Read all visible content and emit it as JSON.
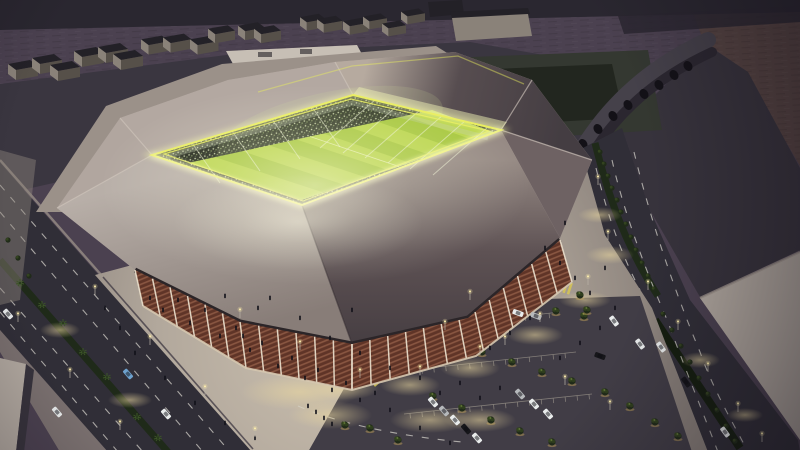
{
  "meta": {
    "title": "Aerial night rendering of an illuminated stadium with glowing pitch, wooden facade, plazas, parking lots and boulevards",
    "type": "architectural-visualization"
  },
  "colors": {
    "desert": "#4b4150",
    "desertRed": "#564442",
    "roadTop": "#2a2730",
    "apron": "#3a3640",
    "dark2": "#37333c",
    "lot": "#b2a9a0",
    "field": "#343831",
    "fieldIn": "#22261f",
    "greenRoof": "#c7bfb5",
    "greenA": "#2d6a33",
    "greenB": "#7fbd5b",
    "viaduct": "#45414a",
    "viaductSide": "#2b2730",
    "arch": "#131117",
    "road": "#302e37",
    "lane": "#d2cfc8",
    "walk": "#9c938a",
    "median": "#1f2a19",
    "hedge": "#151e0f",
    "plazaIn": "#cdc2b1",
    "plazaMid": "#b2a89c",
    "plazaOut": "#89807a",
    "plazaDim": "#8e857c",
    "pool": "#ecd9a0",
    "parking": "#413d46",
    "aisle": "#938d85",
    "apronX": "#9b9189",
    "roofA": "#b1a69f",
    "roofTL": "#b3a8a1",
    "roofTRa": "#b6aa9f",
    "roofTRb": "#574d50",
    "roofTRc": "#443d42",
    "roofR": "#6e6263",
    "roofDa": "#968a84",
    "roofDb": "#5e5254",
    "roofDc": "#463e42",
    "roofLa": "#b8afa8",
    "roofLb": "#887d78",
    "ridge": "#cfc5bb",
    "crease": "#2f282c",
    "under": "#2b2528",
    "wood": "#5f3427",
    "slat": "#8a5742",
    "column": "#eadfcc",
    "base": "#d6c8b0",
    "canopy": "#d9d3c8",
    "rim": "#e9ee5e",
    "rimSoft": "#f7f8ac",
    "rimHot": "#fffce2",
    "trussBand": "#e9ecb2",
    "truss": "#eef2d4",
    "stands": "#1a2014",
    "crowd1": "#dce6b8",
    "crowd2": "#8fa468",
    "crowd3": "#4c5a3c",
    "crowdGlow": "#cfe09a",
    "pitch": "#a6c73d",
    "pitchHi": "#cbe35a",
    "pitchLine": "#eef3c0",
    "boxTop": "#232127",
    "boxFaceL": "#8a8279",
    "boxFaceR": "#565049",
    "treeDark": "#202b19",
    "treeMid": "#33431f",
    "treeHi": "#5d7334",
    "treeGlow": "#caa85c",
    "palm": "#3c5528",
    "person": "#101018",
    "pole": "#b9b2a6",
    "poleLight": "#ffefad",
    "carWhite": "#e9ecec",
    "carSilver": "#b6b9bc",
    "carBlue": "#6ea2ce",
    "carDark": "#16161a",
    "bloom": "#fffbe6",
    "vig": "#120e17",
    "crossYellow": "#d6c654"
  },
  "scene": {
    "warehouses": [
      [
        8,
        72,
        1
      ],
      [
        32,
        66,
        1
      ],
      [
        50,
        73,
        1
      ],
      [
        74,
        59,
        1
      ],
      [
        98,
        55,
        1
      ],
      [
        113,
        62,
        1
      ],
      [
        141,
        47,
        0.95
      ],
      [
        163,
        45,
        0.95
      ],
      [
        190,
        47,
        0.95
      ],
      [
        208,
        36,
        0.9
      ],
      [
        238,
        33,
        0.9
      ],
      [
        254,
        36,
        0.9
      ],
      [
        300,
        24,
        0.85
      ],
      [
        317,
        26,
        0.85
      ],
      [
        343,
        28,
        0.85
      ],
      [
        363,
        23,
        0.8
      ],
      [
        382,
        30,
        0.8
      ],
      [
        401,
        18,
        0.8
      ]
    ],
    "arches": [
      [
        688,
        66
      ],
      [
        674,
        75
      ],
      [
        659,
        85
      ],
      [
        644,
        94
      ],
      [
        628,
        105
      ],
      [
        613,
        116
      ],
      [
        598,
        129
      ],
      [
        583,
        144
      ],
      [
        569,
        159
      ],
      [
        557,
        173
      ]
    ],
    "medianTrees": [
      [
        600,
        152
      ],
      [
        604,
        164
      ],
      [
        608,
        176
      ],
      [
        612,
        188
      ],
      [
        617,
        200
      ],
      [
        621,
        212
      ],
      [
        626,
        224
      ],
      [
        631,
        237
      ],
      [
        636,
        250
      ],
      [
        642,
        263
      ],
      [
        648,
        276
      ],
      [
        654,
        289
      ]
    ],
    "hedgeTrees": [
      [
        663,
        314
      ],
      [
        672,
        330
      ],
      [
        681,
        346
      ],
      [
        690,
        362
      ],
      [
        699,
        378
      ],
      [
        708,
        394
      ],
      [
        717,
        410
      ],
      [
        726,
        426
      ],
      [
        735,
        441
      ]
    ],
    "plazaTrees": [
      [
        498,
        262
      ],
      [
        523,
        265
      ],
      [
        552,
        232
      ],
      [
        550,
        268
      ],
      [
        562,
        272
      ],
      [
        580,
        295
      ],
      [
        587,
        310
      ],
      [
        540,
        300
      ],
      [
        520,
        285
      ],
      [
        505,
        300
      ],
      [
        559,
        253
      ],
      [
        512,
        272
      ]
    ],
    "leftTrees": [
      [
        8,
        240
      ],
      [
        18,
        258
      ],
      [
        29,
        276
      ]
    ],
    "palms": [
      [
        20,
        283
      ],
      [
        42,
        305
      ],
      [
        63,
        323
      ],
      [
        83,
        352
      ],
      [
        107,
        377
      ],
      [
        137,
        417
      ],
      [
        158,
        438
      ]
    ],
    "parkTrees": [
      [
        442,
        296
      ],
      [
        468,
        300
      ],
      [
        497,
        303
      ],
      [
        526,
        307
      ],
      [
        556,
        311
      ],
      [
        584,
        316
      ],
      [
        424,
        332
      ],
      [
        452,
        342
      ],
      [
        482,
        352
      ],
      [
        512,
        362
      ],
      [
        542,
        372
      ],
      [
        572,
        381
      ],
      [
        433,
        396
      ],
      [
        462,
        408
      ],
      [
        491,
        420
      ],
      [
        520,
        431
      ],
      [
        552,
        442
      ],
      [
        605,
        392
      ],
      [
        630,
        406
      ],
      [
        655,
        422
      ],
      [
        678,
        436
      ],
      [
        398,
        440
      ],
      [
        370,
        428
      ],
      [
        345,
        425
      ]
    ],
    "people": [
      [
        150,
        300
      ],
      [
        163,
        312
      ],
      [
        178,
        302
      ],
      [
        190,
        325
      ],
      [
        205,
        312
      ],
      [
        220,
        338
      ],
      [
        236,
        330
      ],
      [
        250,
        352
      ],
      [
        262,
        345
      ],
      [
        278,
        368
      ],
      [
        292,
        360
      ],
      [
        305,
        380
      ],
      [
        318,
        372
      ],
      [
        332,
        392
      ],
      [
        346,
        385
      ],
      [
        360,
        402
      ],
      [
        375,
        395
      ],
      [
        390,
        412
      ],
      [
        270,
        300
      ],
      [
        300,
        320
      ],
      [
        330,
        340
      ],
      [
        360,
        355
      ],
      [
        390,
        370
      ],
      [
        420,
        380
      ],
      [
        440,
        395
      ],
      [
        460,
        385
      ],
      [
        480,
        400
      ],
      [
        500,
        390
      ],
      [
        560,
        360
      ],
      [
        580,
        345
      ],
      [
        600,
        330
      ],
      [
        615,
        310
      ],
      [
        545,
        250
      ],
      [
        560,
        265
      ],
      [
        575,
        280
      ],
      [
        590,
        295
      ],
      [
        605,
        270
      ],
      [
        565,
        225
      ],
      [
        120,
        330
      ],
      [
        105,
        310
      ],
      [
        135,
        355
      ],
      [
        165,
        380
      ],
      [
        195,
        405
      ],
      [
        225,
        425
      ],
      [
        255,
        440
      ],
      [
        308,
        408
      ],
      [
        316,
        414
      ],
      [
        324,
        420
      ],
      [
        332,
        426
      ],
      [
        420,
        430
      ],
      [
        450,
        445
      ],
      [
        352,
        312
      ],
      [
        225,
        298
      ],
      [
        530,
        320
      ],
      [
        510,
        335
      ],
      [
        490,
        350
      ],
      [
        258,
        310
      ],
      [
        243,
        338
      ]
    ],
    "pools": [
      [
        165,
        295,
        28,
        10
      ],
      [
        225,
        330,
        30,
        11
      ],
      [
        285,
        362,
        32,
        12
      ],
      [
        345,
        388,
        34,
        12
      ],
      [
        410,
        385,
        30,
        11
      ],
      [
        470,
        368,
        30,
        11
      ],
      [
        535,
        335,
        28,
        10
      ],
      [
        585,
        300,
        26,
        9
      ],
      [
        610,
        255,
        24,
        9
      ],
      [
        600,
        215,
        22,
        8
      ],
      [
        330,
        415,
        42,
        14
      ],
      [
        430,
        420,
        40,
        13
      ],
      [
        520,
        300,
        26,
        10
      ],
      [
        480,
        420,
        36,
        12
      ],
      [
        300,
        392,
        60,
        18
      ],
      [
        60,
        330,
        20,
        8
      ],
      [
        130,
        400,
        22,
        8
      ],
      [
        700,
        360,
        20,
        8
      ],
      [
        745,
        415,
        18,
        7
      ],
      [
        208,
        300,
        24,
        9
      ]
    ],
    "poles": [
      [
        95,
        295
      ],
      [
        150,
        345
      ],
      [
        205,
        395
      ],
      [
        255,
        437
      ],
      [
        18,
        322
      ],
      [
        70,
        378
      ],
      [
        120,
        430
      ],
      [
        240,
        318
      ],
      [
        300,
        350
      ],
      [
        360,
        378
      ],
      [
        420,
        375
      ],
      [
        480,
        355
      ],
      [
        540,
        322
      ],
      [
        588,
        285
      ],
      [
        608,
        240
      ],
      [
        648,
        290
      ],
      [
        678,
        330
      ],
      [
        708,
        372
      ],
      [
        738,
        412
      ],
      [
        762,
        442
      ],
      [
        445,
        330
      ],
      [
        505,
        345
      ],
      [
        470,
        300
      ],
      [
        565,
        385
      ],
      [
        610,
        410
      ],
      [
        598,
        185
      ]
    ],
    "cars": [
      [
        8,
        314,
        49,
        "carWhite"
      ],
      [
        128,
        374,
        49,
        "carBlue"
      ],
      [
        57,
        412,
        49,
        "carWhite"
      ],
      [
        166,
        414,
        49,
        "carWhite"
      ],
      [
        614,
        321,
        54,
        "carWhite"
      ],
      [
        640,
        344,
        54,
        "carWhite"
      ],
      [
        661,
        347,
        54,
        "carWhite"
      ],
      [
        686,
        382,
        54,
        "carDark"
      ],
      [
        725,
        432,
        54,
        "carWhite"
      ],
      [
        433,
        402,
        49,
        "carWhite"
      ],
      [
        444,
        411,
        49,
        "carSilver"
      ],
      [
        455,
        420,
        49,
        "carWhite"
      ],
      [
        466,
        429,
        49,
        "carDark"
      ],
      [
        477,
        438,
        49,
        "carWhite"
      ],
      [
        520,
        394,
        49,
        "carSilver"
      ],
      [
        534,
        404,
        49,
        "carWhite"
      ],
      [
        548,
        414,
        49,
        "carWhite"
      ],
      [
        518,
        313,
        20,
        "carWhite"
      ],
      [
        536,
        316,
        20,
        "carSilver"
      ],
      [
        600,
        356,
        20,
        "carDark"
      ]
    ],
    "trusses": [
      [
        375,
        100,
        320,
        148
      ],
      [
        398,
        105,
        343,
        153
      ],
      [
        420,
        110,
        365,
        158
      ],
      [
        443,
        115,
        388,
        163
      ],
      [
        465,
        121,
        410,
        169
      ],
      [
        488,
        127,
        433,
        175
      ],
      [
        192,
        143,
        220,
        183
      ],
      [
        232,
        131,
        260,
        171
      ],
      [
        272,
        119,
        300,
        159
      ],
      [
        312,
        107,
        340,
        147
      ]
    ],
    "crosswalks": [
      {
        "x": 372,
        "y": 374,
        "r": 50,
        "n": 6
      },
      {
        "x": 412,
        "y": 304,
        "r": 18,
        "n": 5
      },
      {
        "x": 562,
        "y": 286,
        "r": 18,
        "n": 5
      }
    ],
    "aisles": [
      [
        400,
        330,
        560,
        312
      ],
      [
        392,
        372,
        576,
        352
      ],
      [
        404,
        414,
        592,
        394
      ]
    ],
    "pitch": {
      "E": [
        [
          188,
          163
        ],
        [
          432,
          110
        ]
      ],
      "F": [
        [
          302,
          200
        ],
        [
          496,
          133
        ]
      ],
      "stripes": 9
    },
    "facadeLeft": {
      "top": [
        [
          135,
          270
        ],
        [
          240,
          322
        ],
        [
          352,
          344
        ]
      ],
      "bottom": [
        [
          143,
          306
        ],
        [
          246,
          368
        ],
        [
          352,
          390
        ]
      ],
      "n": 13
    },
    "facadeRight": {
      "top": [
        [
          352,
          344
        ],
        [
          468,
          318
        ],
        [
          560,
          240
        ]
      ],
      "bottom": [
        [
          352,
          390
        ],
        [
          476,
          356
        ],
        [
          572,
          282
        ]
      ],
      "n": 14
    }
  }
}
